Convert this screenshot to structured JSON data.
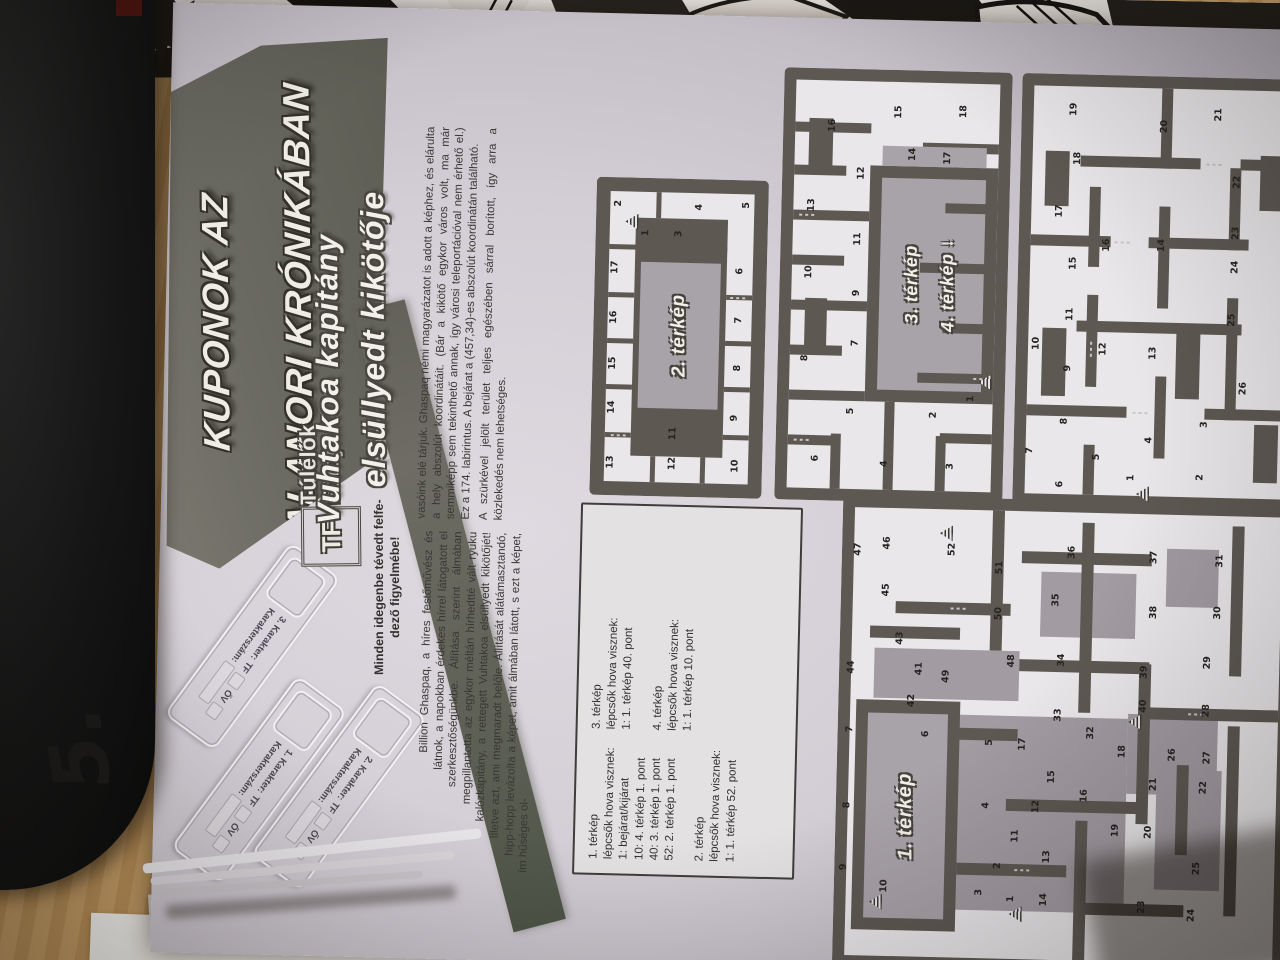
{
  "photo": {
    "handwritten_note": "5."
  },
  "kicker": {
    "line1": "KUPONOK AZ",
    "line2": "ALANORI KRÓNIKÁBAN"
  },
  "logo": {
    "monogram": "TF",
    "name_line1": "Túlélők",
    "name_line2": "Földje"
  },
  "lead": {
    "line1": "Minden idegenbe tévedt felfe-",
    "line2": "dező figyelmébe!"
  },
  "title": {
    "line1": "Vuhtakoa kapitány",
    "line2": "elsüllyedt kikötője"
  },
  "article": {
    "col1": "Billion Ghaspaq, a híres festőművész és látnok, a napokban érdekes hírrel látogatott el szerkesztőségünkbe. Állítása szerint álmában megpillantotta az egykor méltán hírhedtté vált ryuku kalózkapitány, a rettegett Vuhtakoa elsüllyedt kikötőjét! Illetve azt, ami megmaradt belőle. Állítását alátámasztandó, hipp-hopp levázolta a képet, amit álmában látott, s ezt a képet, ím hűséges ol-",
    "col2_p1": "vasóink elé tárjuk. Ghaspaq némi magyarázatot is adott a képhez, és elárulta a hely abszolút koordinátáit. (Bár a kikötő egykor város volt, ma már semmiképp sem tekinthető annak, így városi teleportációval nem érhető el.) Ez a 174. labirintus. A bejárat a (457,34)-es abszolút koordinátán található.",
    "col2_p2": "A szürkével jelölt terület teljes egészében sárral borított, így arra a közlekedés nem lehetséges."
  },
  "coupons": {
    "num_labels": [
      "1. Karakter:",
      "2. Karakter:",
      "3. Karakter:"
    ],
    "tf_label": "TF",
    "ov_label": "ŐV",
    "num_field_label": "Karakterszám:"
  },
  "legend": {
    "col1": "1. térkép\nlépcsők hova visznek:\n1: bejárat/kijárat\n10: 4. térkép 1. pont\n40: 3. térkép 1. pont\n52: 2. térkép 1. pont\n\n2. térkép\nlépcsők hova visznek:\n1: 1. térkép 52. pont",
    "col2": "3. térkép\nlépcsők hova visznek:\n1: 1. térkép 40. pont\n\n4. térkép\nlépcsők hova visznek:\n1: 1. térkép 10. pont"
  },
  "maps": {
    "map1": {
      "label": "1. térkép",
      "numbers": [
        [
          1,
          72,
          177
        ],
        [
          2,
          105,
          163
        ],
        [
          3,
          78,
          145
        ],
        [
          4,
          165,
          150
        ],
        [
          5,
          228,
          152
        ],
        [
          6,
          235,
          88
        ],
        [
          7,
          238,
          12
        ],
        [
          8,
          162,
          11
        ],
        [
          9,
          100,
          9
        ],
        [
          10,
          82,
          50
        ],
        [
          11,
          135,
          180
        ],
        [
          12,
          165,
          200
        ],
        [
          13,
          115,
          212
        ],
        [
          14,
          72,
          210
        ],
        [
          15,
          195,
          215
        ],
        [
          16,
          177,
          248
        ],
        [
          17,
          227,
          185
        ],
        [
          18,
          222,
          285
        ],
        [
          19,
          143,
          280
        ],
        [
          20,
          142,
          313
        ],
        [
          21,
          190,
          317
        ],
        [
          22,
          188,
          367
        ],
        [
          23,
          67,
          308
        ],
        [
          24,
          60,
          358
        ],
        [
          25,
          107,
          362
        ],
        [
          26,
          220,
          335
        ],
        [
          27,
          218,
          370
        ],
        [
          28,
          265,
          368
        ],
        [
          29,
          313,
          368
        ],
        [
          30,
          363,
          377
        ],
        [
          31,
          415,
          378
        ],
        [
          32,
          240,
          253
        ],
        [
          33,
          257,
          220
        ],
        [
          34,
          312,
          222
        ],
        [
          35,
          372,
          215
        ],
        [
          36,
          420,
          230
        ],
        [
          37,
          417,
          312
        ],
        [
          38,
          362,
          313
        ],
        [
          39,
          302,
          305
        ],
        [
          40,
          268,
          305
        ],
        [
          41,
          300,
          80
        ],
        [
          42,
          268,
          73
        ],
        [
          43,
          330,
          60
        ],
        [
          44,
          300,
          12
        ],
        [
          45,
          378,
          45
        ],
        [
          46,
          425,
          45
        ],
        [
          47,
          418,
          16
        ],
        [
          48,
          310,
          172
        ],
        [
          49,
          293,
          107
        ],
        [
          50,
          357,
          158
        ],
        [
          51,
          403,
          158
        ],
        [
          52,
          420,
          110
        ]
      ],
      "ladders": [
        [
          57,
          182
        ],
        [
          66,
          42
        ],
        [
          252,
          297
        ],
        [
          436,
          104
        ]
      ]
    },
    "map2": {
      "label": "2. térkép",
      "numbers": [
        [
          1,
          263,
          50
        ],
        [
          2,
          292,
          22
        ],
        [
          3,
          263,
          83
        ],
        [
          4,
          290,
          103
        ],
        [
          5,
          293,
          150
        ],
        [
          6,
          227,
          145
        ],
        [
          7,
          178,
          145
        ],
        [
          8,
          130,
          145
        ],
        [
          9,
          80,
          143
        ],
        [
          10,
          32,
          145
        ],
        [
          11,
          63,
          82
        ],
        [
          12,
          33,
          82
        ],
        [
          13,
          33,
          20
        ],
        [
          14,
          88,
          20
        ],
        [
          15,
          132,
          20
        ],
        [
          16,
          178,
          20
        ],
        [
          17,
          228,
          20
        ]
      ],
      "ladders": [
        [
          274,
          36
        ]
      ]
    },
    "map3": {
      "label_line1": "3. térkép",
      "label_line2": "4. térkép",
      "arrow": "↓",
      "numbers": [
        [
          1,
          105,
          194
        ],
        [
          2,
          88,
          157
        ],
        [
          3,
          37,
          175
        ],
        [
          4,
          38,
          109
        ],
        [
          5,
          90,
          74
        ],
        [
          6,
          42,
          40
        ],
        [
          7,
          158,
          77
        ],
        [
          8,
          142,
          27
        ],
        [
          9,
          208,
          77
        ],
        [
          10,
          228,
          29
        ],
        [
          11,
          262,
          77
        ],
        [
          12,
          328,
          79
        ],
        [
          13,
          295,
          30
        ],
        [
          14,
          348,
          130
        ],
        [
          15,
          390,
          115
        ],
        [
          16,
          375,
          49
        ],
        [
          17,
          345,
          165
        ],
        [
          18,
          392,
          180
        ]
      ],
      "ladders": [
        [
          122,
          208
        ]
      ]
    },
    "map4": {
      "numbers": [
        [
          1,
          30,
          118
        ],
        [
          2,
          32,
          187
        ],
        [
          3,
          85,
          190
        ],
        [
          4,
          68,
          135
        ],
        [
          5,
          50,
          83
        ],
        [
          6,
          22,
          47
        ],
        [
          7,
          55,
          16
        ],
        [
          8,
          85,
          50
        ],
        [
          9,
          138,
          52
        ],
        [
          10,
          162,
          20
        ],
        [
          11,
          192,
          53
        ],
        [
          12,
          158,
          87
        ],
        [
          13,
          155,
          137
        ],
        [
          14,
          263,
          143
        ],
        [
          15,
          243,
          55
        ],
        [
          16,
          262,
          88
        ],
        [
          17,
          295,
          40
        ],
        [
          18,
          348,
          57
        ],
        [
          19,
          397,
          52
        ],
        [
          20,
          382,
          143
        ],
        [
          21,
          395,
          197
        ],
        [
          22,
          328,
          217
        ],
        [
          23,
          277,
          217
        ],
        [
          24,
          243,
          217
        ],
        [
          25,
          190,
          215
        ],
        [
          26,
          122,
          228
        ]
      ],
      "ladders": [
        [
          14,
          130
        ]
      ]
    }
  }
}
